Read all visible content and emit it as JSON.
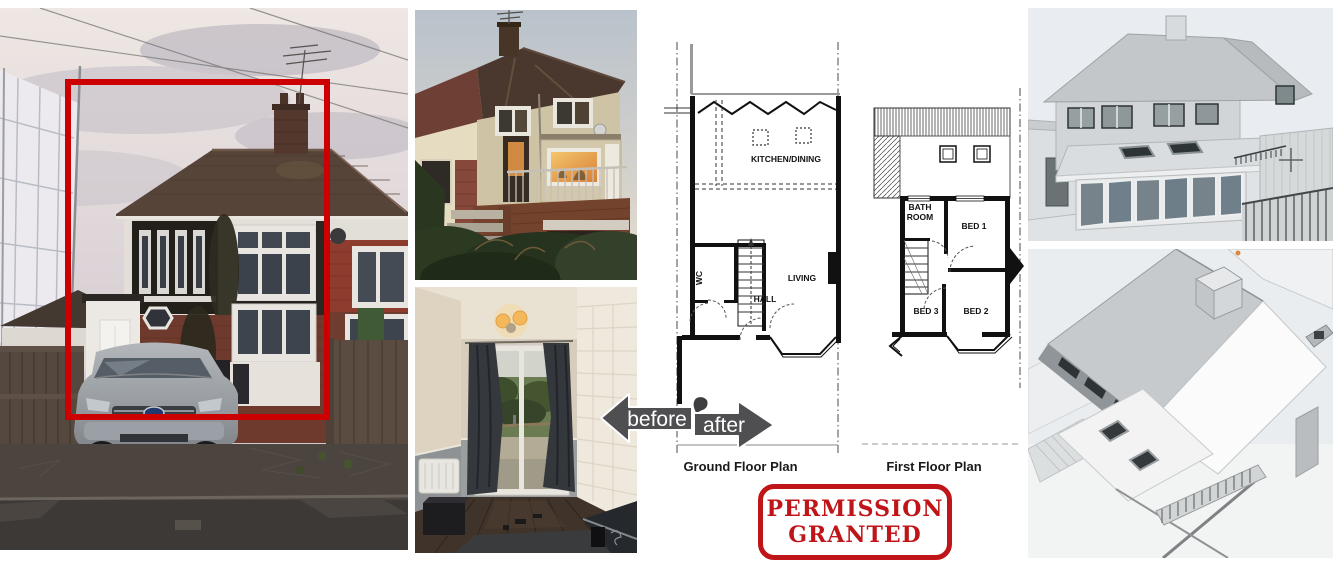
{
  "colors": {
    "highlight_box": "#cc0000",
    "stamp_red": "#bf1519",
    "arrow_gray": "#4f4f51",
    "render_sky": "#e9edf1"
  },
  "floor_plans": {
    "ground": {
      "caption": "Ground Floor Plan",
      "rooms": {
        "kitchen_dining": "KITCHEN/DINING",
        "living": "LIVING",
        "hall": "HALL",
        "wc": "WC"
      }
    },
    "first": {
      "caption": "First Floor Plan",
      "rooms": {
        "bath_line1": "BATH",
        "bath_line2": "ROOM",
        "bed1": "BED 1",
        "bed2": "BED 2",
        "bed3": "BED 3"
      }
    }
  },
  "arrows": {
    "before": "before",
    "after": "after"
  },
  "stamp": {
    "line1": "PERMISSION",
    "line2": "GRANTED"
  }
}
